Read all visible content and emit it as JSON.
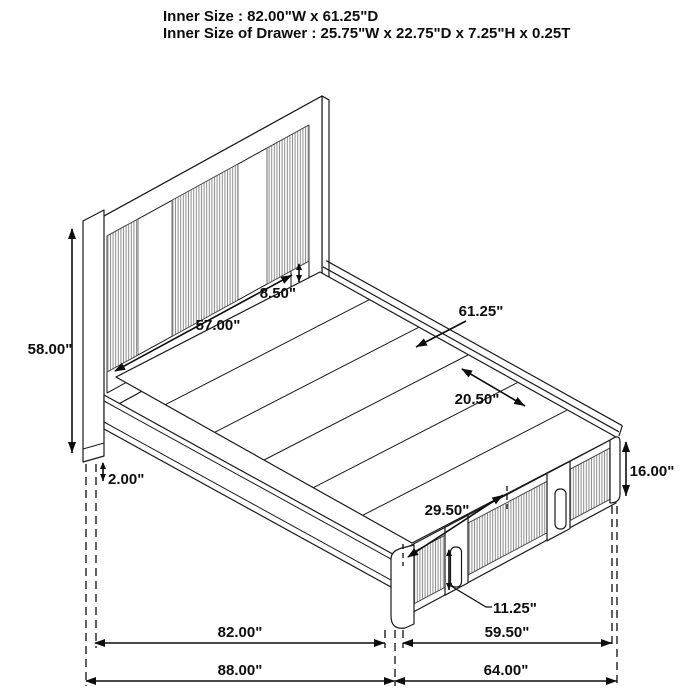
{
  "header": {
    "line1": "Inner Size : 82.00\"W x 61.25\"D",
    "line2": "Inner Size of Drawer : 25.75\"W x 22.75\"D x 7.25\"H x 0.25T"
  },
  "dims": {
    "height_overall": "58.00\"",
    "headboard_width": "57.00\"",
    "rail_offset": "8.50\"",
    "depth_inner": "61.25\"",
    "deck_segment": "20.50\"",
    "drawer_span": "29.50\"",
    "platform_height": "16.00\"",
    "drawer_front_height": "11.25\"",
    "floor_clearance": "2.00\"",
    "width_inner": "82.00\"",
    "drawer_area_width": "59.50\"",
    "width_overall": "88.00\"",
    "depth_overall": "64.00\""
  },
  "colors": {
    "line": "#1a1a1a",
    "text": "#0d0d0d",
    "flute": "#8c8c8c",
    "background": "#ffffff"
  }
}
